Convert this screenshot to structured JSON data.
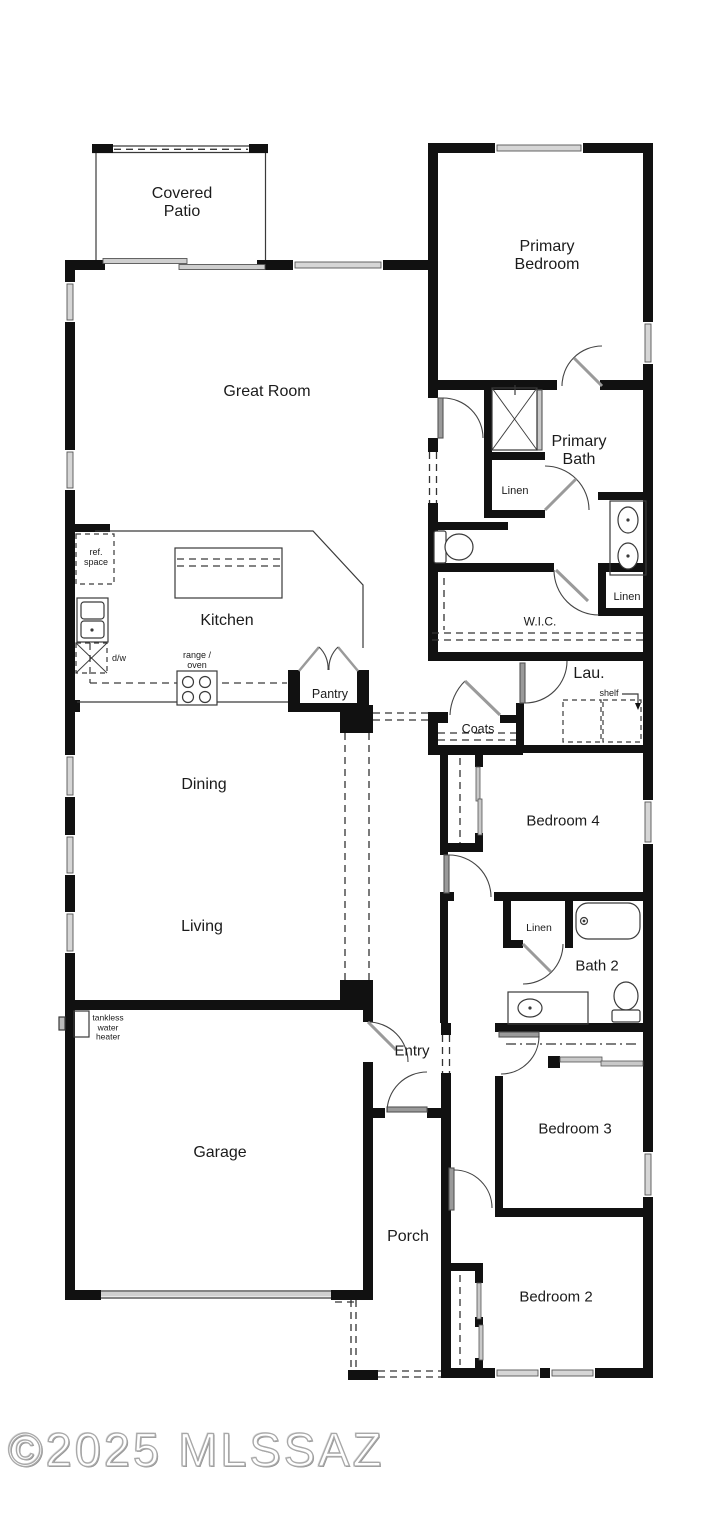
{
  "watermark": "©2025 MLSSAZ",
  "rooms": {
    "covered_patio": {
      "line1": "Covered",
      "line2": "Patio"
    },
    "great_room": "Great Room",
    "primary_bedroom": {
      "line1": "Primary",
      "line2": "Bedroom"
    },
    "primary_bath": {
      "line1": "Primary",
      "line2": "Bath"
    },
    "wic": "W.I.C.",
    "kitchen": "Kitchen",
    "pantry": "Pantry",
    "laundry": "Lau.",
    "coats": "Coats",
    "dining": "Dining",
    "living": "Living",
    "bedroom4": "Bedroom 4",
    "bath2": "Bath 2",
    "bedroom3": "Bedroom 3",
    "bedroom2": "Bedroom 2",
    "garage": "Garage",
    "entry": "Entry",
    "porch": "Porch"
  },
  "closets": {
    "linen_primary_bath": "Linen",
    "linen_wic": "Linen",
    "linen_bath2": "Linen",
    "shelf": "shelf"
  },
  "appliances": {
    "ref_space": {
      "line1": "ref.",
      "line2": "space"
    },
    "dishwasher": "d/w",
    "range_oven": {
      "line1": "range /",
      "line2": "oven"
    },
    "tankless": {
      "line1": "tankless",
      "line2": "water",
      "line3": "heater"
    }
  },
  "colors": {
    "wall": "#111111",
    "window_fill": "#d6d6d6",
    "door_leaf": "#9a9a9a",
    "thin_line": "#3a3a3a",
    "watermark": "#a8a8a8"
  }
}
